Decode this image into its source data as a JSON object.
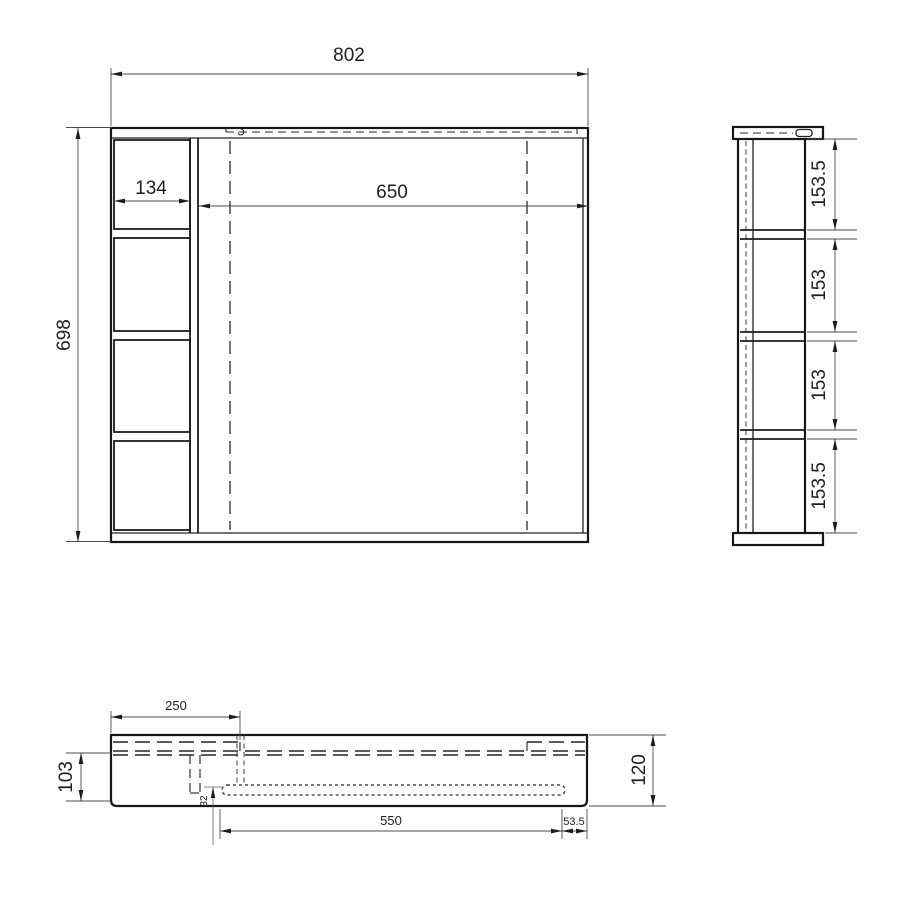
{
  "drawing": {
    "front_view": {
      "overall_width": "802",
      "overall_height": "698",
      "shelf_width": "134",
      "mirror_width": "650"
    },
    "side_view": {
      "segments": [
        "153.5",
        "153",
        "153",
        "153.5"
      ]
    },
    "bottom_view": {
      "back_panel_width": "250",
      "body_depth": "103",
      "overall_depth": "120",
      "groove_length": "550",
      "groove_right_offset": "53.5",
      "groove_edge_inset": "32"
    },
    "colors": {
      "object_line": "#1a1a1a",
      "dimension_line": "#4d4d4d",
      "background": "#ffffff"
    }
  }
}
